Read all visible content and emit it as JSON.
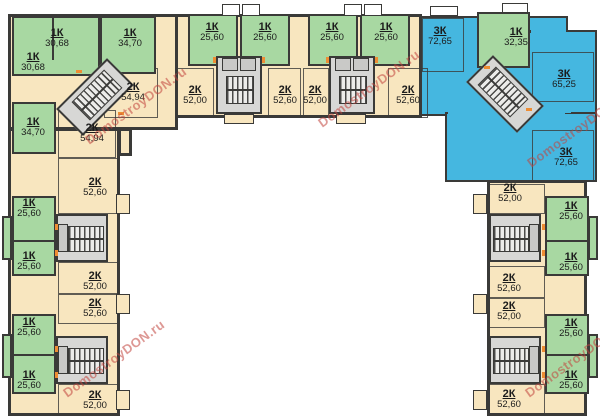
{
  "watermark": {
    "text": "DomostroyDON.ru"
  },
  "colors": {
    "one_room": "#a8d8a2",
    "two_room": "#f8e6bf",
    "three_room": "#45b7e0",
    "stairs": "#d7d7d5",
    "wall": "#3a3a38",
    "accent_orange": "#ee8d33",
    "watermark_red": "#c2443e"
  },
  "apartments": [
    {
      "type": "1К",
      "area": "30,68"
    },
    {
      "type": "1К",
      "area": "30,68"
    },
    {
      "type": "1К",
      "area": "34,70"
    },
    {
      "type": "1К",
      "area": "25,60"
    },
    {
      "type": "1К",
      "area": "25,60"
    },
    {
      "type": "1К",
      "area": "25,60"
    },
    {
      "type": "1К",
      "area": "25,60"
    },
    {
      "type": "3К",
      "area": "72,65"
    },
    {
      "type": "1К",
      "area": "32,35"
    },
    {
      "type": "2К",
      "area": "54,94"
    },
    {
      "type": "2К",
      "area": "52,00"
    },
    {
      "type": "2К",
      "area": "52,60"
    },
    {
      "type": "2К",
      "area": "52,00"
    },
    {
      "type": "2К",
      "area": "52,60"
    },
    {
      "type": "3К",
      "area": "65,25"
    },
    {
      "type": "2К",
      "area": "54,94"
    },
    {
      "type": "1К",
      "area": "34,70"
    },
    {
      "type": "3К",
      "area": "72,65"
    },
    {
      "type": "2К",
      "area": "52,60"
    },
    {
      "type": "1К",
      "area": "25,60"
    },
    {
      "type": "1К",
      "area": "25,60"
    },
    {
      "type": "2К",
      "area": "52,00"
    },
    {
      "type": "2К",
      "area": "52,60"
    },
    {
      "type": "1К",
      "area": "25,60"
    },
    {
      "type": "1К",
      "area": "25,60"
    },
    {
      "type": "2К",
      "area": "52,00"
    },
    {
      "type": "2К",
      "area": "52,00"
    },
    {
      "type": "1К",
      "area": "25,60"
    },
    {
      "type": "1К",
      "area": "25,60"
    },
    {
      "type": "2К",
      "area": "52,60"
    },
    {
      "type": "2К",
      "area": "52,00"
    },
    {
      "type": "1К",
      "area": "25,60"
    },
    {
      "type": "1К",
      "area": "25,60"
    },
    {
      "type": "2К",
      "area": "52,60"
    }
  ]
}
